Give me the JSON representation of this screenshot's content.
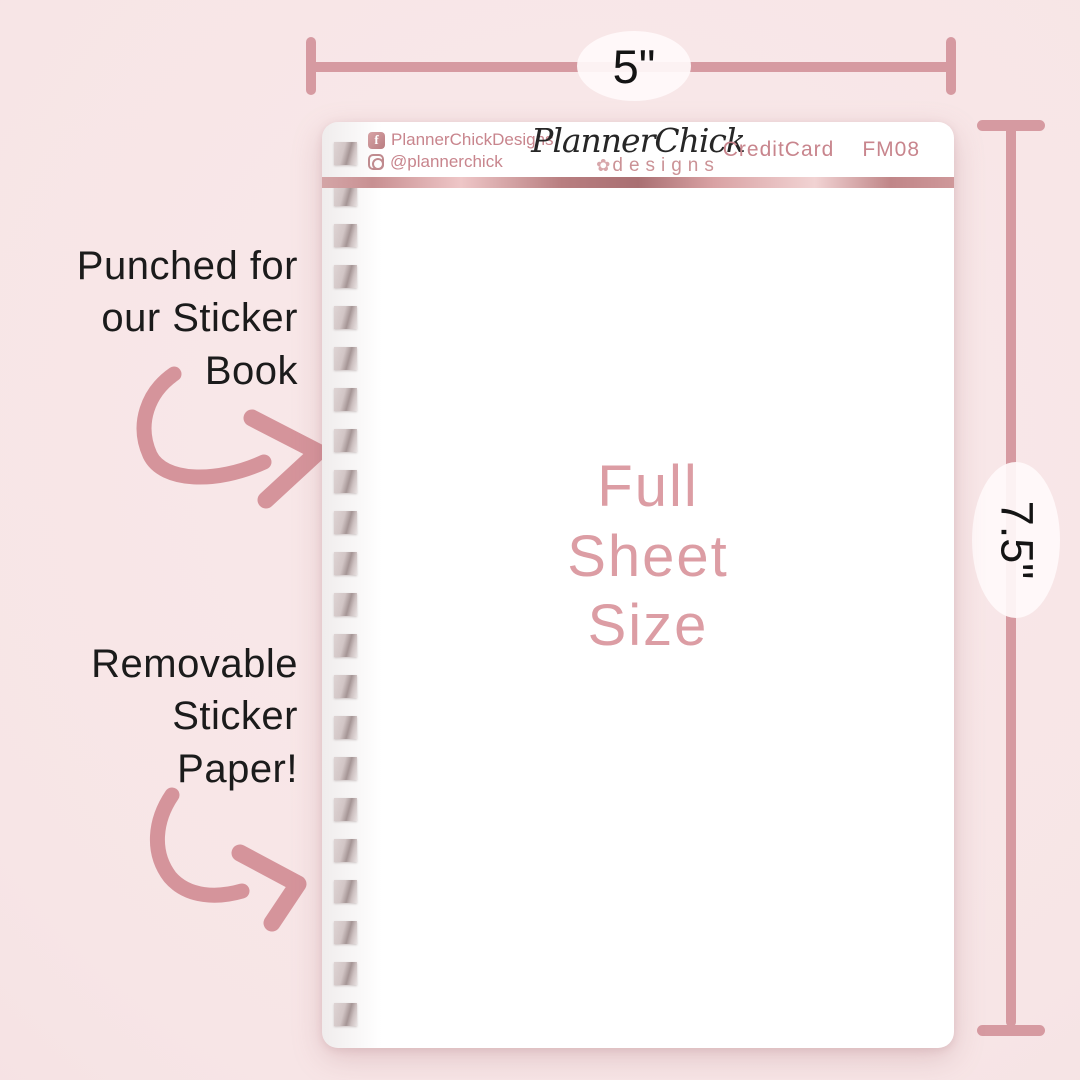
{
  "rulers": {
    "width_label": "5\"",
    "height_label": "7.5\""
  },
  "annotations": {
    "punched": "Punched for\nour Sticker\nBook",
    "removable": "Removable\nSticker\nPaper!"
  },
  "sheet": {
    "social": {
      "facebook": "PlannerChickDesigns",
      "instagram": "@plannerchick"
    },
    "brand": {
      "script": "PlannerChick",
      "sub": "designs"
    },
    "product": {
      "name": "CreditCard",
      "code": "FM08"
    },
    "center_label": "Full\nSheet\nSize",
    "hole_count": 22
  },
  "icons": {
    "facebook_glyph": "f",
    "flower_glyph": "✿"
  },
  "colors": {
    "background": "#f7e5e6",
    "ruler_pink": "#d69aa1",
    "arrow_pink": "#d5949b",
    "accent_text_pink": "#c8858d",
    "center_text_pink": "#dc9da4",
    "ink": "#1b1b1b"
  }
}
